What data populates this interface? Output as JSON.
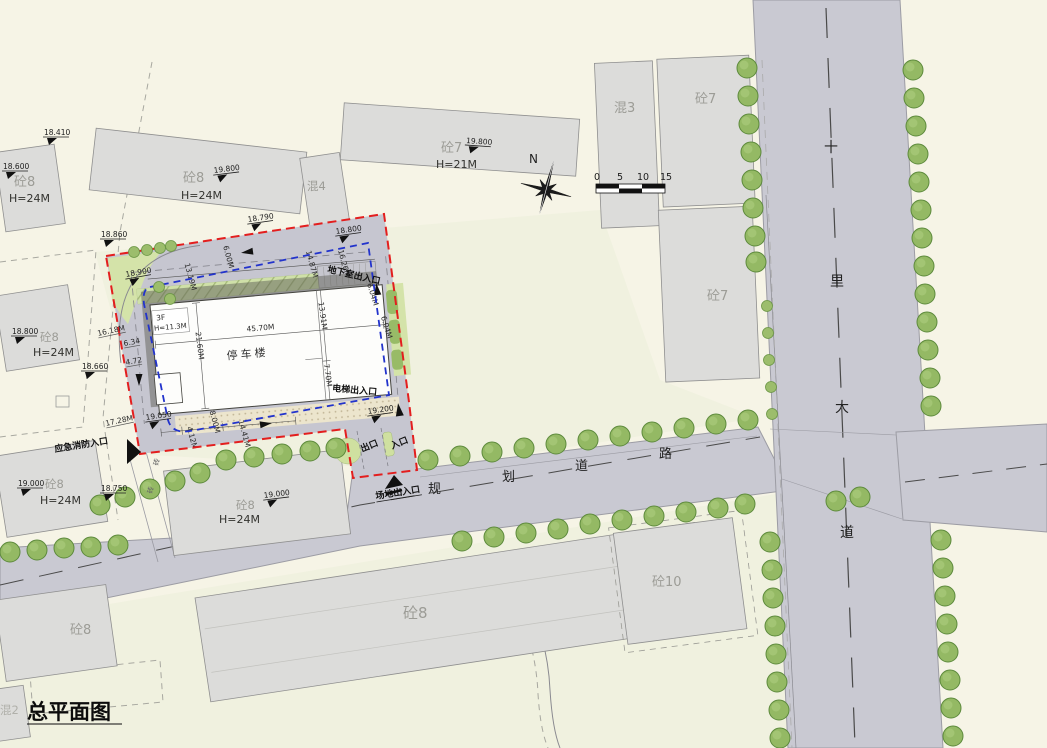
{
  "title": "总平面图",
  "compass": {
    "label": "N"
  },
  "scale_bar": {
    "ticks": [
      "0",
      "5",
      "10",
      "15"
    ]
  },
  "roads": {
    "planned": [
      "规",
      "划",
      "道",
      "路"
    ],
    "avenue": [
      "十",
      "里",
      "大",
      "道"
    ]
  },
  "parking": {
    "name": "停车楼",
    "floors": "3F",
    "height": "H=11.3M",
    "dims": {
      "length": "45.70M",
      "width": "21.60M",
      "right_upper": "13.91M",
      "right_lower": "7.70M",
      "ne_a": "6.04M",
      "ne_b": "6.04M",
      "top_a": "13.19M",
      "top_b": "14.87M",
      "top_c": "16.26M",
      "aisle": "6.00M",
      "west_a": "16.18M",
      "west_b": "6.34",
      "west_c": "4.72",
      "sw": "17.28M",
      "south_a": "4.12M",
      "south_b": "8.00M",
      "south_c": "14.41M"
    }
  },
  "entrances": {
    "basement": "地下室出入口",
    "elevator": "电梯出入口",
    "exit": "出口",
    "entry": "入口",
    "site_gate": "场地出入口",
    "emergency": "应急消防入口"
  },
  "buildings": {
    "nw": {
      "name": "砼8",
      "height": "H=24M",
      "elev": "18.600"
    },
    "n1": {
      "name": "砼8",
      "height": "H=24M",
      "elev": "19.800"
    },
    "n2": {
      "name": "混4"
    },
    "n3": {
      "name": "砼7",
      "height": "H=21M",
      "elev": "19.800"
    },
    "e1": {
      "name": "混3"
    },
    "e2": {
      "name": "砼7"
    },
    "e3": {
      "name": "砼7"
    },
    "w1": {
      "name": "砼8",
      "height": "H=24M",
      "elev": "18.800"
    },
    "w2": {
      "name": "砼8",
      "height": "H=24M",
      "elev": "19.000"
    },
    "s1": {
      "name": "砼8",
      "height": "H=24M",
      "elev": "19.000"
    },
    "s2": {
      "name": "砼8"
    },
    "s3": {
      "name": "砼10"
    },
    "sw1": {
      "name": "砼8"
    },
    "sw2": {
      "name": "混2"
    }
  },
  "spots": {
    "a": "18.410",
    "b": "18.860",
    "c": "18.790",
    "d": "18.900",
    "e": "18.800",
    "f": "18.660",
    "g": "19.050",
    "h": "19.200",
    "i": "18.750"
  },
  "misc": {
    "brick": "砖"
  },
  "colors": {
    "site_boundary_red": "#e31e1e",
    "setback_blue": "#2233cc",
    "road_gray": "#c9c9d2",
    "tree_green": "#94b964"
  }
}
